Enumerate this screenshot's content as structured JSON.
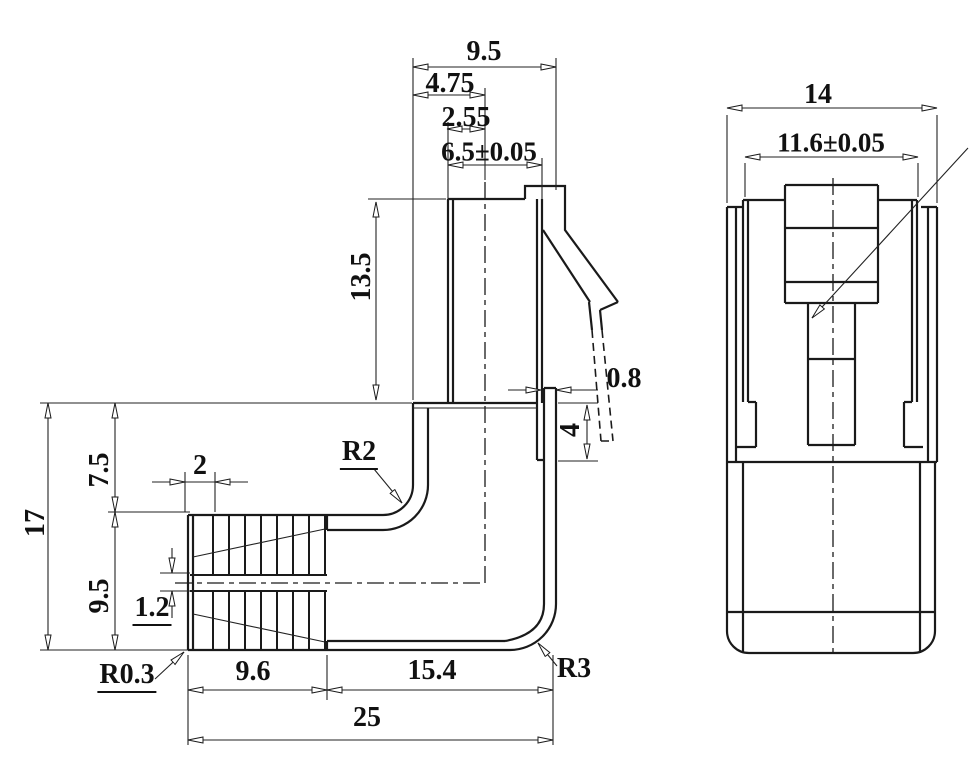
{
  "side_view": {
    "plug_width_total": "9.5",
    "plug_center_offset": "4.75",
    "plug_edge_to_center": "2.55",
    "plug_body_width": "6.5±0.05",
    "plug_height": "13.5",
    "latch_wall_thickness": "0.8",
    "latch_slot_depth": "4",
    "body_height_total": "17",
    "body_height_upper": "7.5",
    "body_height_lower": "9.5",
    "rib_pitch": "2",
    "rib_gap": "1.2",
    "fillet_inner": "R2",
    "fillet_boot_tip": "R0.3",
    "fillet_corner": "R3",
    "boot_length": "9.6",
    "body_length": "15.4",
    "overall_length": "25"
  },
  "front_view": {
    "overall_width": "14",
    "shell_width": "11.6±0.05"
  },
  "line_colors": {
    "outline": "#1a1a1a",
    "thin": "#222222"
  }
}
